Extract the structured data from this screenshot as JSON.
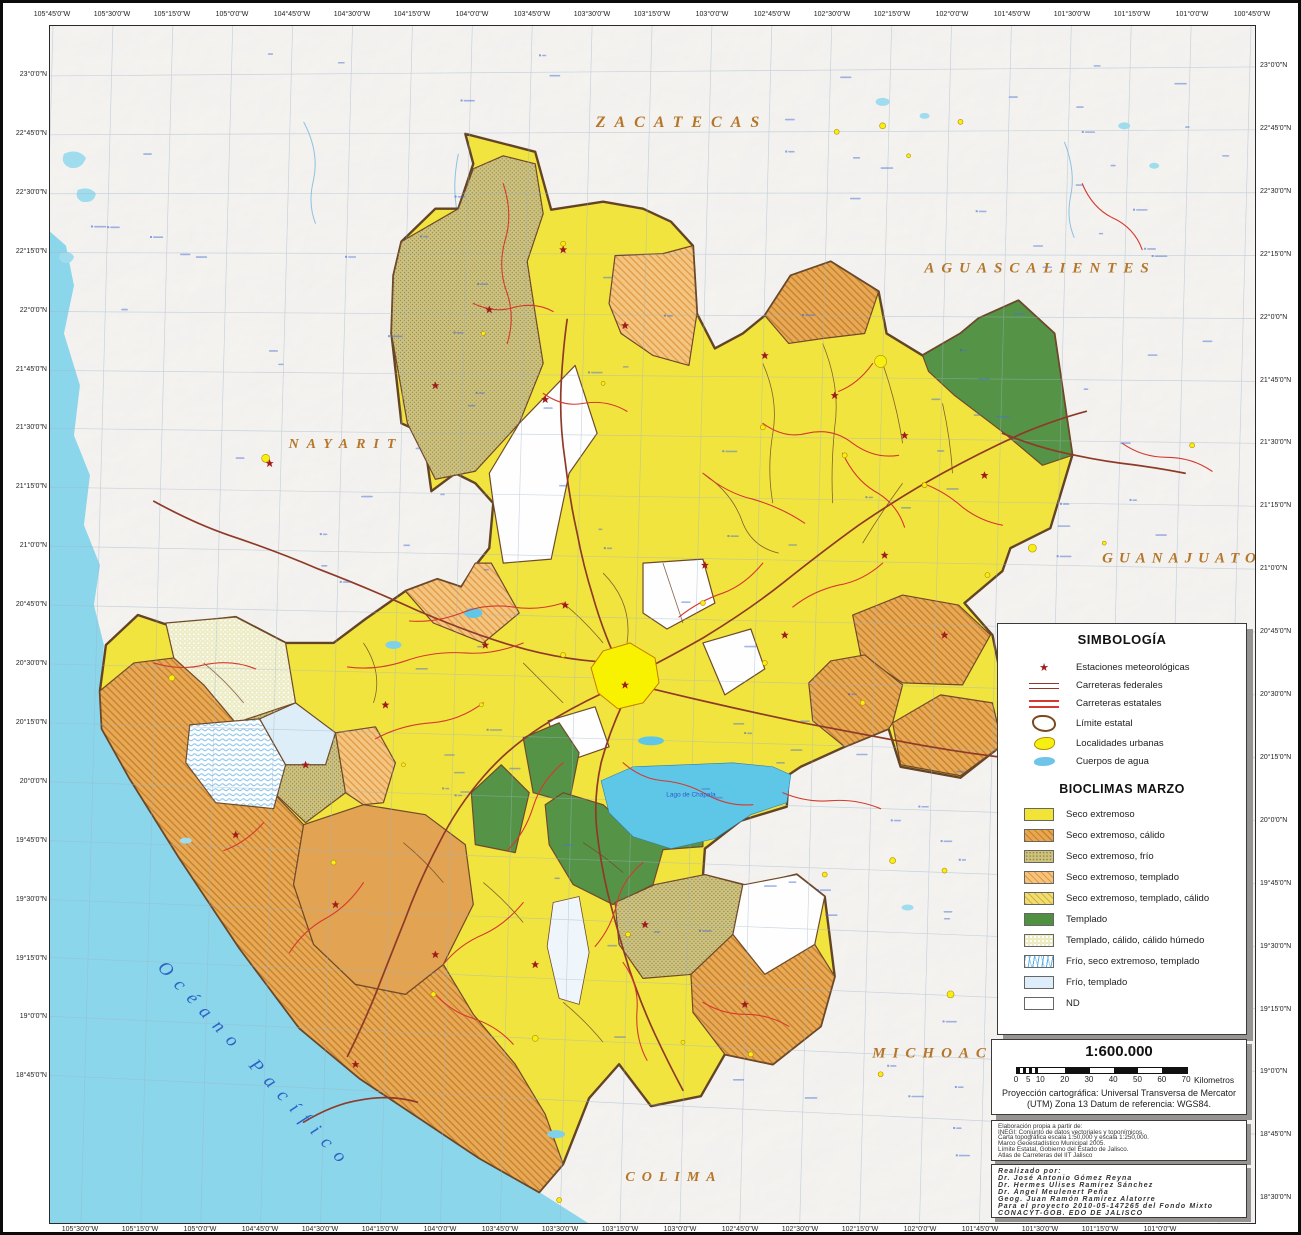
{
  "colors": {
    "seco": "#f2e437",
    "seco_calido": "#e8a74e",
    "seco_frio": "#cfc37c",
    "seco_templado": "#f5c47c",
    "seco_templado_calido": "#f0dd72",
    "templado": "#4f9141",
    "templado_calido_humedo": "#ecebc2",
    "frio_templado": "#ddeefa",
    "nd": "#ffffff",
    "ocean": "#8bd6ea",
    "lake": "#5ec6e6",
    "road_federal": "#8f3a28",
    "road_state": "#d5392f",
    "boundary": "#6b4423",
    "urban": "#f6ef12",
    "region_label": "#b5762a",
    "water_label": "#2d62c8",
    "grid": "#9db4c8",
    "land": "#d9d7d3"
  },
  "map": {
    "regions": [
      {
        "text": "ZACATECAS"
      },
      {
        "text": "AGUASCALIENTES"
      },
      {
        "text": "NAYARIT"
      },
      {
        "text": "GUANAJUATO"
      },
      {
        "text": "MICHOACÁN"
      },
      {
        "text": "COLIMA"
      }
    ],
    "ocean_label": "Océano Pacífico",
    "lake_label": "Lago de Chapala",
    "coordinates": {
      "top": [
        "105°45'0\"W",
        "105°30'0\"W",
        "105°15'0\"W",
        "105°0'0\"W",
        "104°45'0\"W",
        "104°30'0\"W",
        "104°15'0\"W",
        "104°0'0\"W",
        "103°45'0\"W",
        "103°30'0\"W",
        "103°15'0\"W",
        "103°0'0\"W",
        "102°45'0\"W",
        "102°30'0\"W",
        "102°15'0\"W",
        "102°0'0\"W",
        "101°45'0\"W",
        "101°30'0\"W",
        "101°15'0\"W",
        "101°0'0\"W",
        "100°45'0\"W"
      ],
      "bottom": [
        "105°30'0\"W",
        "105°15'0\"W",
        "105°0'0\"W",
        "104°45'0\"W",
        "104°30'0\"W",
        "104°15'0\"W",
        "104°0'0\"W",
        "103°45'0\"W",
        "103°30'0\"W",
        "103°15'0\"W",
        "103°0'0\"W",
        "102°45'0\"W",
        "102°30'0\"W",
        "102°15'0\"W",
        "102°0'0\"W",
        "101°45'0\"W",
        "101°30'0\"W",
        "101°15'0\"W",
        "101°0'0\"W"
      ],
      "left": [
        "23°0'0\"N",
        "22°45'0\"N",
        "22°30'0\"N",
        "22°15'0\"N",
        "22°0'0\"N",
        "21°45'0\"N",
        "21°30'0\"N",
        "21°15'0\"N",
        "21°0'0\"N",
        "20°45'0\"N",
        "20°30'0\"N",
        "20°15'0\"N",
        "20°0'0\"N",
        "19°45'0\"N",
        "19°30'0\"N",
        "19°15'0\"N",
        "19°0'0\"N",
        "18°45'0\"N"
      ],
      "right": [
        "23°0'0\"N",
        "22°45'0\"N",
        "22°30'0\"N",
        "22°15'0\"N",
        "22°0'0\"N",
        "21°45'0\"N",
        "21°30'0\"N",
        "21°15'0\"N",
        "21°0'0\"N",
        "20°45'0\"N",
        "20°30'0\"N",
        "20°15'0\"N",
        "20°0'0\"N",
        "19°45'0\"N",
        "19°30'0\"N",
        "19°15'0\"N",
        "19°0'0\"N",
        "18°45'0\"N",
        "18°30'0\"N"
      ]
    }
  },
  "legend": {
    "title": "SIMBOLOGÍA",
    "symbols": [
      {
        "label": "Estaciones meteorológicas",
        "icon": "star"
      },
      {
        "label": "Carreteras federales",
        "icon": "line-federal"
      },
      {
        "label": "Carreteras estatales",
        "icon": "line-state"
      },
      {
        "label": "Límite estatal",
        "icon": "boundary"
      },
      {
        "label": "Localidades urbanas",
        "icon": "urban"
      },
      {
        "label": "Cuerpos de agua",
        "icon": "water"
      }
    ],
    "bioclimas_title": "BIOCLIMAS MARZO",
    "bioclimas": [
      {
        "label": "Seco extremoso",
        "swatch": "seco"
      },
      {
        "label": "Seco extremoso, cálido",
        "swatch": "seco_calido"
      },
      {
        "label": "Seco extremoso, frío",
        "swatch": "seco_frio"
      },
      {
        "label": "Seco extremoso, templado",
        "swatch": "seco_templado"
      },
      {
        "label": "Seco extremoso, templado, cálido",
        "swatch": "seco_templado_calido"
      },
      {
        "label": "Templado",
        "swatch": "templado"
      },
      {
        "label": "Templado, cálido, cálido húmedo",
        "swatch": "templado_calido_humedo"
      },
      {
        "label": "Frío, seco extremoso, templado",
        "swatch": "frio_seco_templado"
      },
      {
        "label": "Frío, templado",
        "swatch": "frio_templado"
      },
      {
        "label": "ND",
        "swatch": "nd"
      }
    ]
  },
  "scale": {
    "ratio": "1:600.000",
    "tick_labels": [
      "0",
      "5",
      "10",
      "20",
      "30",
      "40",
      "50",
      "60",
      "70"
    ],
    "unit": "Kilometros",
    "projection_line1": "Proyección cartográfica: Universal Transversa de Mercator",
    "projection_line2": "(UTM) Zona 13 Datum de referencia: WGS84."
  },
  "credits": {
    "source_lines": [
      "Elaboración propia a partir de:",
      "INEGI: Conjunto de datos vectoriales y toponímicos.",
      "Carta topográfica escala 1:50,000 y escala 1:250,000.",
      "Marco Geoestadístico Municipal 2005.",
      "Límite Estatal, Gobierno del Estado de Jalisco.",
      "Atlas de Carreteras del IIT Jalisco"
    ],
    "authors_lines": [
      "Realizado por:",
      "Dr. José Antonio Gómez Reyna",
      "Dr. Hermes Ulises Ramírez Sánchez",
      "Dr. Ángel Meulenert Peña",
      "Geog. Juan Ramón Ramírez Alatorre",
      "Para el proyecto 2010-05-147265 del Fondo Mixto",
      "CONACYT-GOB. EDO DE JALISCO"
    ]
  }
}
